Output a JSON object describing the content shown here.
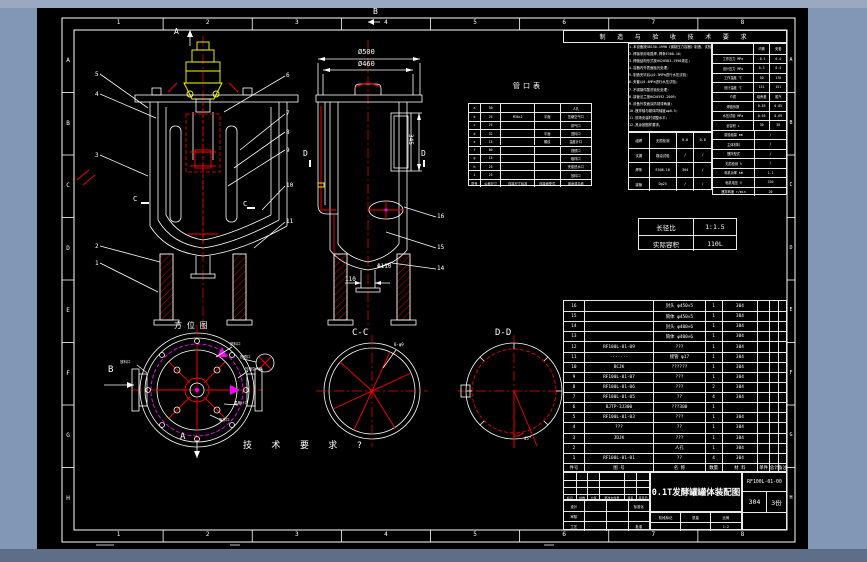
{
  "border": {
    "top_zones": [
      "1",
      "2",
      "3",
      "4",
      "5",
      "6",
      "7",
      "8"
    ],
    "bottom_zones": [
      "1",
      "2",
      "3",
      "4",
      "5",
      "6",
      "7",
      "8"
    ],
    "left_zones": [
      "A",
      "B",
      "C",
      "D",
      "E",
      "F",
      "G",
      "H"
    ],
    "right_zones": [
      "A",
      "B",
      "C",
      "D",
      "E",
      "F",
      "G",
      "H"
    ]
  },
  "notes_band": "制 造 与 验 收 技 术 要 求",
  "notes_lines": [
    "1.本设备按GB150-1998《钢制压力容器》制造、试验和验收;",
    "2.焊接采用电弧焊,焊条E308-16;",
    "3.焊缝结构形式按HG20583-1998规定;",
    "4.容器内外表面抛光处理;",
    "5.制造完毕后以0.3MPa进行水压试验;",
    "6.夹套以0.4MPa进行水压试验;",
    "7.不锈钢件酸洗钝化处理;",
    "8.接管法兰按HG20592-2009;",
    "9.设备外表面涂防锈漆两道;",
    "10.搅拌轴与罐体同轴度≤φ0.5;",
    "11.现场安装时调整水平;",
    "12.其余按图样要求。"
  ],
  "nozzle_table": {
    "title": "管口表",
    "header": [
      "符号",
      "公称尺寸",
      "连接尺寸标准",
      "连接面型式",
      "用途或名称"
    ],
    "rows": [
      [
        "a",
        "50",
        "",
        "",
        "人孔"
      ],
      [
        "b",
        "25",
        "M36×2",
        "平面",
        "压缩空气口"
      ],
      [
        "c",
        "25",
        "",
        "",
        "排气口"
      ],
      [
        "d",
        "32",
        "",
        "平面",
        "进料口"
      ],
      [
        "e",
        "15",
        "",
        "螺纹",
        "温度计口"
      ],
      [
        "f",
        "80",
        "",
        "",
        "视镜口"
      ],
      [
        "g",
        "15",
        "",
        "",
        "取样口"
      ],
      [
        "h",
        "25",
        "",
        "",
        "夹套进水口"
      ],
      [
        "i",
        "25",
        "",
        "",
        "放料口"
      ]
    ]
  },
  "weld_table": {
    "rows": [
      [
        "组焊",
        "无损检测",
        "0.6",
        "0.8"
      ],
      [
        "试漏",
        "煤油试验",
        "/",
        "/"
      ],
      [
        "焊条",
        "E308-16",
        "304",
        "/"
      ],
      [
        "接管",
        "Dg25",
        "/",
        "/"
      ]
    ]
  },
  "tech_table": {
    "rows": [
      [
        "",
        "内筒",
        "夹套"
      ],
      [
        "工作压力 MPa",
        "-0.1",
        "0.4"
      ],
      [
        "设计压力 MPa",
        "0.3",
        "0.4"
      ],
      [
        "工作温度 ℃",
        "50",
        "170"
      ],
      [
        "设计温度 ℃",
        "151",
        "151"
      ],
      [
        "介质",
        "培养基",
        "蒸汽"
      ],
      [
        "焊缝系数",
        "0.85",
        "0.85"
      ],
      [
        "水压试验 MPa",
        "0.65",
        "0.69"
      ],
      [
        "全容积 L",
        "30",
        "30"
      ],
      [
        "腐蚀裕量 mm",
        "/"
      ],
      [
        "主体材料",
        "/"
      ],
      [
        "搅拌型式",
        "/"
      ],
      [
        "无损检测 %",
        "/"
      ],
      [
        "电机功率 kW",
        "1.1"
      ],
      [
        "电机电压 V",
        "220"
      ],
      [
        "搅拌转速 r/min",
        "20"
      ]
    ]
  },
  "ratio_table": {
    "rows": [
      [
        "长径比",
        "1:1.5"
      ],
      [
        "实际容积",
        "110L"
      ]
    ]
  },
  "bom": {
    "header": [
      "件号",
      "图 号",
      "名 称",
      "数量",
      "材 料",
      "单件",
      "总计",
      "备注"
    ],
    "rows": [
      [
        "16",
        "",
        "封头 φ450×5",
        "1",
        "304",
        "",
        "",
        ""
      ],
      [
        "15",
        "",
        "筒体 φ450×5",
        "1",
        "304",
        "",
        "",
        ""
      ],
      [
        "14",
        "",
        "封头 φ400×6",
        "1",
        "304",
        "",
        "",
        ""
      ],
      [
        "13",
        "",
        "筒体 φ400×6",
        "1",
        "304",
        "",
        "",
        ""
      ],
      [
        "12",
        "RF100L-01-09",
        "???",
        "1",
        "304",
        "",
        "",
        ""
      ],
      [
        "11",
        "·······",
        "接管 φ17",
        "1",
        "304",
        "",
        "",
        ""
      ],
      [
        "10",
        "BCJK",
        "??????",
        "1",
        "304",
        "",
        "",
        ""
      ],
      [
        "9",
        "RF100L-01-07",
        "???",
        "1",
        "304",
        "",
        "",
        ""
      ],
      [
        "8",
        "RF100L-01-06",
        "???",
        "2",
        "304",
        "",
        "",
        ""
      ],
      [
        "7",
        "RF100L-01-05",
        "??",
        "4",
        "304",
        "",
        "",
        ""
      ],
      [
        "6",
        "BJTP-3J300",
        "???300",
        "1",
        "",
        "",
        "",
        ""
      ],
      [
        "5",
        "RF100L-01-03",
        "???",
        "1",
        "304",
        "",
        "",
        ""
      ],
      [
        "4",
        "???",
        "??",
        "1",
        "304",
        "",
        "",
        ""
      ],
      [
        "3",
        "JDJK",
        "???",
        "1",
        "304",
        "",
        "",
        ""
      ],
      [
        "2",
        "",
        "人孔",
        "1",
        "304",
        "",
        "",
        ""
      ],
      [
        "1",
        "RF100L-01-01",
        "??",
        "4",
        "304",
        "",
        "",
        ""
      ]
    ]
  },
  "title_block": {
    "title": "0.1T发酵罐罐体装配图",
    "drawing_no": "RF100L-01-00",
    "material": "304",
    "copies": "3份",
    "rev_rows": [
      [
        "",
        "",
        "",
        "",
        "",
        ""
      ],
      [
        "",
        "",
        "",
        "",
        "",
        ""
      ],
      [
        "",
        "",
        "",
        "",
        "",
        ""
      ],
      [
        "标记",
        "处数",
        "分区",
        "更改文件号",
        "签名",
        "年月日"
      ]
    ],
    "sign_rows": [
      [
        "设计",
        "",
        "",
        "标准化"
      ],
      [
        "审核",
        "",
        "",
        ""
      ],
      [
        "工艺",
        "",
        "",
        "批准"
      ]
    ],
    "stage_rows": [
      [
        "阶段标记",
        "质量",
        "比例"
      ],
      [
        "",
        "",
        "1:2"
      ]
    ]
  },
  "annotations": [
    {
      "x": 174,
      "y": 28,
      "t": "A",
      "fs": 8
    },
    {
      "x": 373,
      "y": 8,
      "t": "B",
      "fs": 8
    },
    {
      "x": 358,
      "y": 49,
      "t": "Ø500",
      "fs": 7
    },
    {
      "x": 358,
      "y": 61,
      "t": "Ø460",
      "fs": 7
    },
    {
      "x": 413,
      "y": 134,
      "t": "345",
      "fs": 6,
      "rot": 90
    },
    {
      "x": 377,
      "y": 264,
      "t": "Φ110",
      "fs": 6
    },
    {
      "x": 345,
      "y": 277,
      "t": "110",
      "fs": 6
    },
    {
      "x": 303,
      "y": 150,
      "t": "D",
      "fs": 8
    },
    {
      "x": 421,
      "y": 150,
      "t": "D",
      "fs": 8
    },
    {
      "x": 133,
      "y": 196,
      "t": "C",
      "fs": 7
    },
    {
      "x": 243,
      "y": 201,
      "t": "C",
      "fs": 7
    },
    {
      "x": 352,
      "y": 329,
      "t": "C-C",
      "fs": 9
    },
    {
      "x": 495,
      "y": 329,
      "t": "D-D",
      "fs": 9
    },
    {
      "x": 174,
      "y": 322,
      "t": "方 位 图",
      "fs": 8
    },
    {
      "x": 243,
      "y": 442,
      "t": "技 术 要 求 ?",
      "fs": 9,
      "ls": 7
    },
    {
      "x": 108,
      "y": 366,
      "t": "B",
      "fs": 9
    },
    {
      "x": 180,
      "y": 433,
      "t": "A",
      "fs": 9
    },
    {
      "x": 513,
      "y": 83,
      "t": "管口表",
      "fs": 7,
      "ls": 3
    },
    {
      "x": 394,
      "y": 343,
      "t": "8-φ9",
      "fs": 4
    },
    {
      "x": 524,
      "y": 437,
      "t": "45°",
      "fs": 4
    },
    {
      "x": 95,
      "y": 72,
      "t": "5",
      "fs": 6
    },
    {
      "x": 95,
      "y": 92,
      "t": "4",
      "fs": 6
    },
    {
      "x": 95,
      "y": 153,
      "t": "3",
      "fs": 6
    },
    {
      "x": 95,
      "y": 244,
      "t": "2",
      "fs": 6
    },
    {
      "x": 95,
      "y": 261,
      "t": "1",
      "fs": 6
    },
    {
      "x": 286,
      "y": 73,
      "t": "6",
      "fs": 6
    },
    {
      "x": 286,
      "y": 111,
      "t": "7",
      "fs": 6
    },
    {
      "x": 286,
      "y": 130,
      "t": "8",
      "fs": 6
    },
    {
      "x": 286,
      "y": 148,
      "t": "9",
      "fs": 6
    },
    {
      "x": 286,
      "y": 183,
      "t": "10",
      "fs": 6
    },
    {
      "x": 286,
      "y": 219,
      "t": "11",
      "fs": 6
    },
    {
      "x": 437,
      "y": 214,
      "t": "16",
      "fs": 6
    },
    {
      "x": 437,
      "y": 245,
      "t": "15",
      "fs": 6
    },
    {
      "x": 437,
      "y": 266,
      "t": "14",
      "fs": 6
    },
    {
      "x": 230,
      "y": 343,
      "t": "进料口",
      "fs": 3.5
    },
    {
      "x": 240,
      "y": 356,
      "t": "视镜口",
      "fs": 3.5
    },
    {
      "x": 245,
      "y": 368,
      "t": "压缩空气口",
      "fs": 3.5
    },
    {
      "x": 234,
      "y": 402,
      "t": "温度计口",
      "fs": 3.5
    },
    {
      "x": 219,
      "y": 419,
      "t": "取样口",
      "fs": 3.5
    },
    {
      "x": 120,
      "y": 361,
      "t": "放料口",
      "fs": 3.5
    }
  ]
}
